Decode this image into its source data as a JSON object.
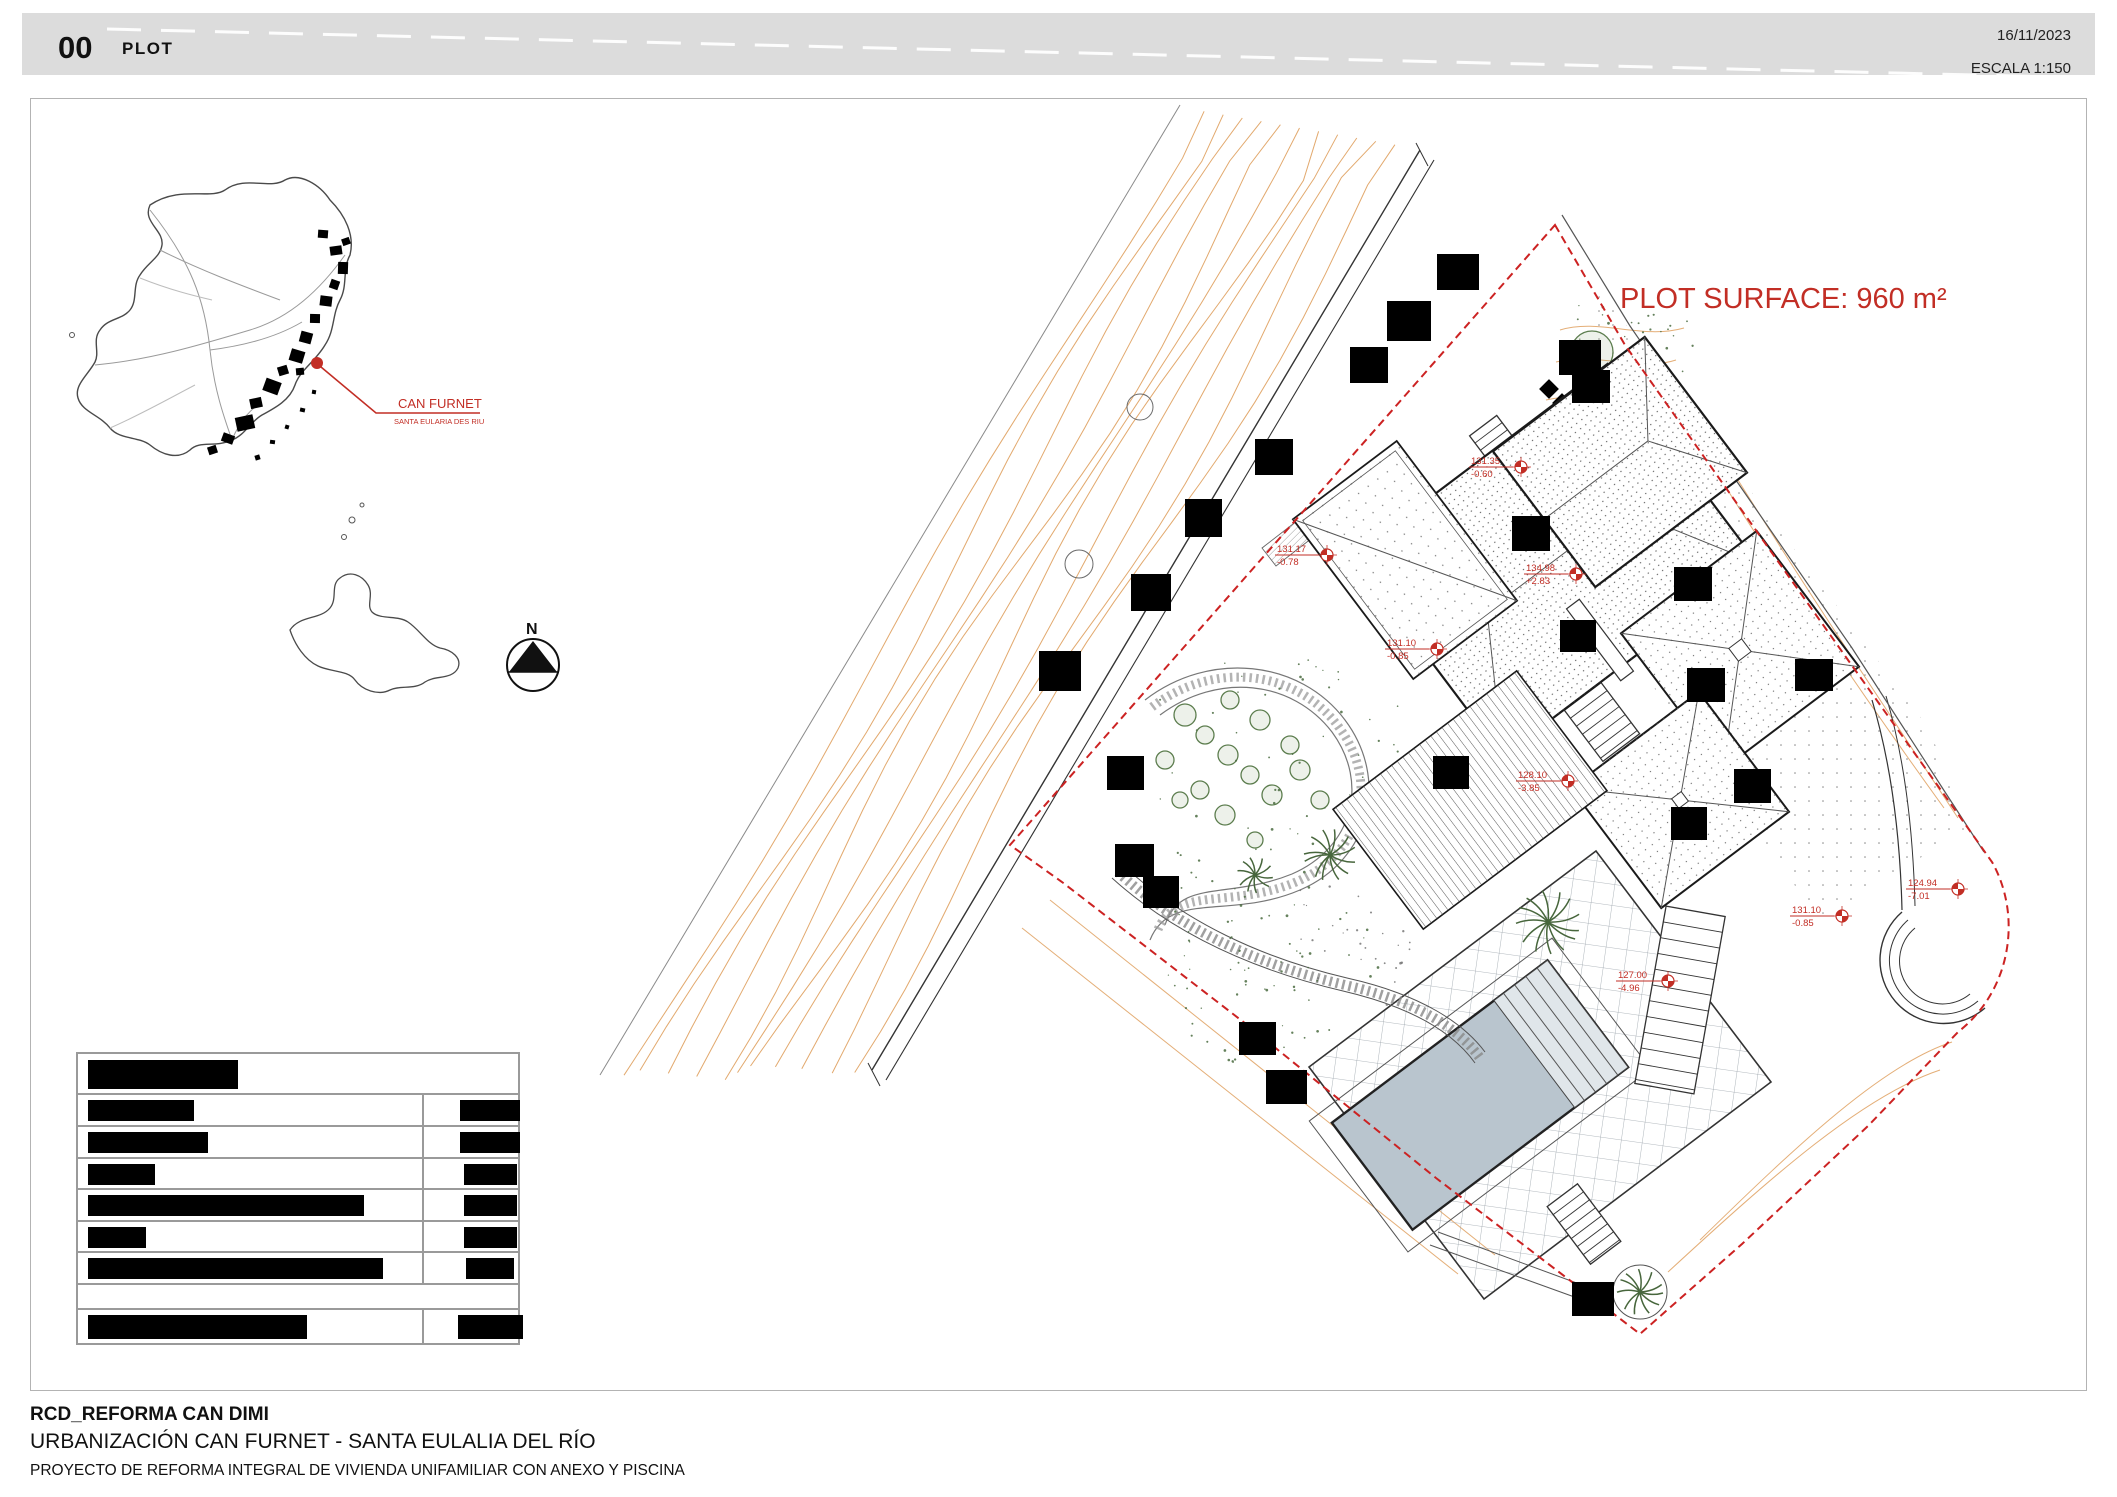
{
  "header": {
    "sheet_number": "00",
    "sheet_title": "PLOT",
    "date": "16/11/2023",
    "scale_label": "ESCALA 1:150"
  },
  "map": {
    "location_label": "CAN FURNET",
    "location_sublabel": "SANTA EULARIA DES RIU",
    "north_label": "N",
    "accent_color": "#c22e25",
    "urban_blobs": [
      [
        318,
        230,
        10,
        8
      ],
      [
        330,
        246,
        12,
        9
      ],
      [
        338,
        262,
        10,
        12
      ],
      [
        330,
        280,
        9,
        9
      ],
      [
        320,
        296,
        12,
        10
      ],
      [
        310,
        314,
        10,
        9
      ],
      [
        300,
        332,
        12,
        11
      ],
      [
        290,
        350,
        14,
        12
      ],
      [
        278,
        366,
        10,
        9
      ],
      [
        264,
        380,
        16,
        13
      ],
      [
        250,
        398,
        12,
        10
      ],
      [
        236,
        416,
        18,
        14
      ],
      [
        222,
        434,
        12,
        9
      ],
      [
        208,
        446,
        9,
        8
      ],
      [
        296,
        368,
        8,
        7
      ],
      [
        342,
        238,
        8,
        7
      ],
      [
        255,
        455,
        5,
        5
      ],
      [
        270,
        440,
        5,
        4
      ],
      [
        285,
        425,
        4,
        4
      ],
      [
        300,
        408,
        5,
        4
      ],
      [
        312,
        390,
        4,
        4
      ]
    ],
    "location_dot": [
      317,
      363
    ]
  },
  "plan": {
    "surface_label": "PLOT SURFACE: 960 m²",
    "surface_color": "#c22e25",
    "boundary_color": "#cc2222",
    "contour_color": "#dd9a55",
    "pool_color": "#b9c5ce",
    "pool_steps_color": "#e0e6ea",
    "vegetation_color": "#5c7d4e",
    "level_markers": [
      {
        "x": 1521,
        "y": 467,
        "level": "131.35",
        "relative": "-0.60"
      },
      {
        "x": 1327,
        "y": 555,
        "level": "131.17",
        "relative": "-0.78"
      },
      {
        "x": 1576,
        "y": 574,
        "level": "134.98",
        "relative": "+2.83"
      },
      {
        "x": 1437,
        "y": 649,
        "level": "131.10",
        "relative": "-0.85"
      },
      {
        "x": 1568,
        "y": 781,
        "level": "128.10",
        "relative": "-3.85"
      },
      {
        "x": 1842,
        "y": 916,
        "level": "131.10",
        "relative": "-0.85"
      },
      {
        "x": 1958,
        "y": 889,
        "level": "124.94",
        "relative": "-7.01"
      },
      {
        "x": 1668,
        "y": 981,
        "level": "127.00",
        "relative": "-4.96"
      }
    ],
    "redactions": [
      [
        1437,
        254,
        42,
        36
      ],
      [
        1387,
        301,
        44,
        40
      ],
      [
        1350,
        347,
        38,
        36
      ],
      [
        1255,
        439,
        38,
        36
      ],
      [
        1185,
        499,
        37,
        38
      ],
      [
        1131,
        574,
        40,
        37
      ],
      [
        1039,
        651,
        42,
        40
      ],
      [
        1107,
        756,
        37,
        34
      ],
      [
        1115,
        844,
        39,
        33
      ],
      [
        1143,
        876,
        36,
        32
      ],
      [
        1239,
        1022,
        37,
        33
      ],
      [
        1266,
        1070,
        41,
        34
      ],
      [
        1559,
        340,
        42,
        35
      ],
      [
        1572,
        370,
        38,
        33
      ],
      [
        1512,
        516,
        38,
        35
      ],
      [
        1560,
        620,
        36,
        32
      ],
      [
        1674,
        567,
        38,
        34
      ],
      [
        1687,
        668,
        38,
        34
      ],
      [
        1795,
        659,
        38,
        32
      ],
      [
        1734,
        769,
        37,
        34
      ],
      [
        1671,
        807,
        36,
        33
      ],
      [
        1433,
        756,
        36,
        33
      ],
      [
        1572,
        1282,
        42,
        34
      ]
    ]
  },
  "legend_table": {
    "rows": [
      {
        "type": "header",
        "left_bar": 150,
        "right_bar": 0
      },
      {
        "type": "data",
        "left_bar": 106,
        "right_bar": 60
      },
      {
        "type": "data",
        "left_bar": 120,
        "right_bar": 60
      },
      {
        "type": "data",
        "left_bar": 67,
        "right_bar": 53
      },
      {
        "type": "data",
        "left_bar": 276,
        "right_bar": 53
      },
      {
        "type": "data",
        "left_bar": 58,
        "right_bar": 53
      },
      {
        "type": "data",
        "left_bar": 295,
        "right_bar": 48
      },
      {
        "type": "empty",
        "left_bar": 0,
        "right_bar": 0
      },
      {
        "type": "data",
        "left_bar": 219,
        "right_bar": 65
      }
    ]
  },
  "footer": {
    "project_code": "RCD_REFORMA CAN DIMI",
    "location_line": "URBANIZACIÓN CAN FURNET - SANTA EULALIA DEL RÍO",
    "description_line": "PROYECTO DE REFORMA INTEGRAL DE VIVIENDA UNIFAMILIAR CON ANEXO Y PISCINA"
  }
}
